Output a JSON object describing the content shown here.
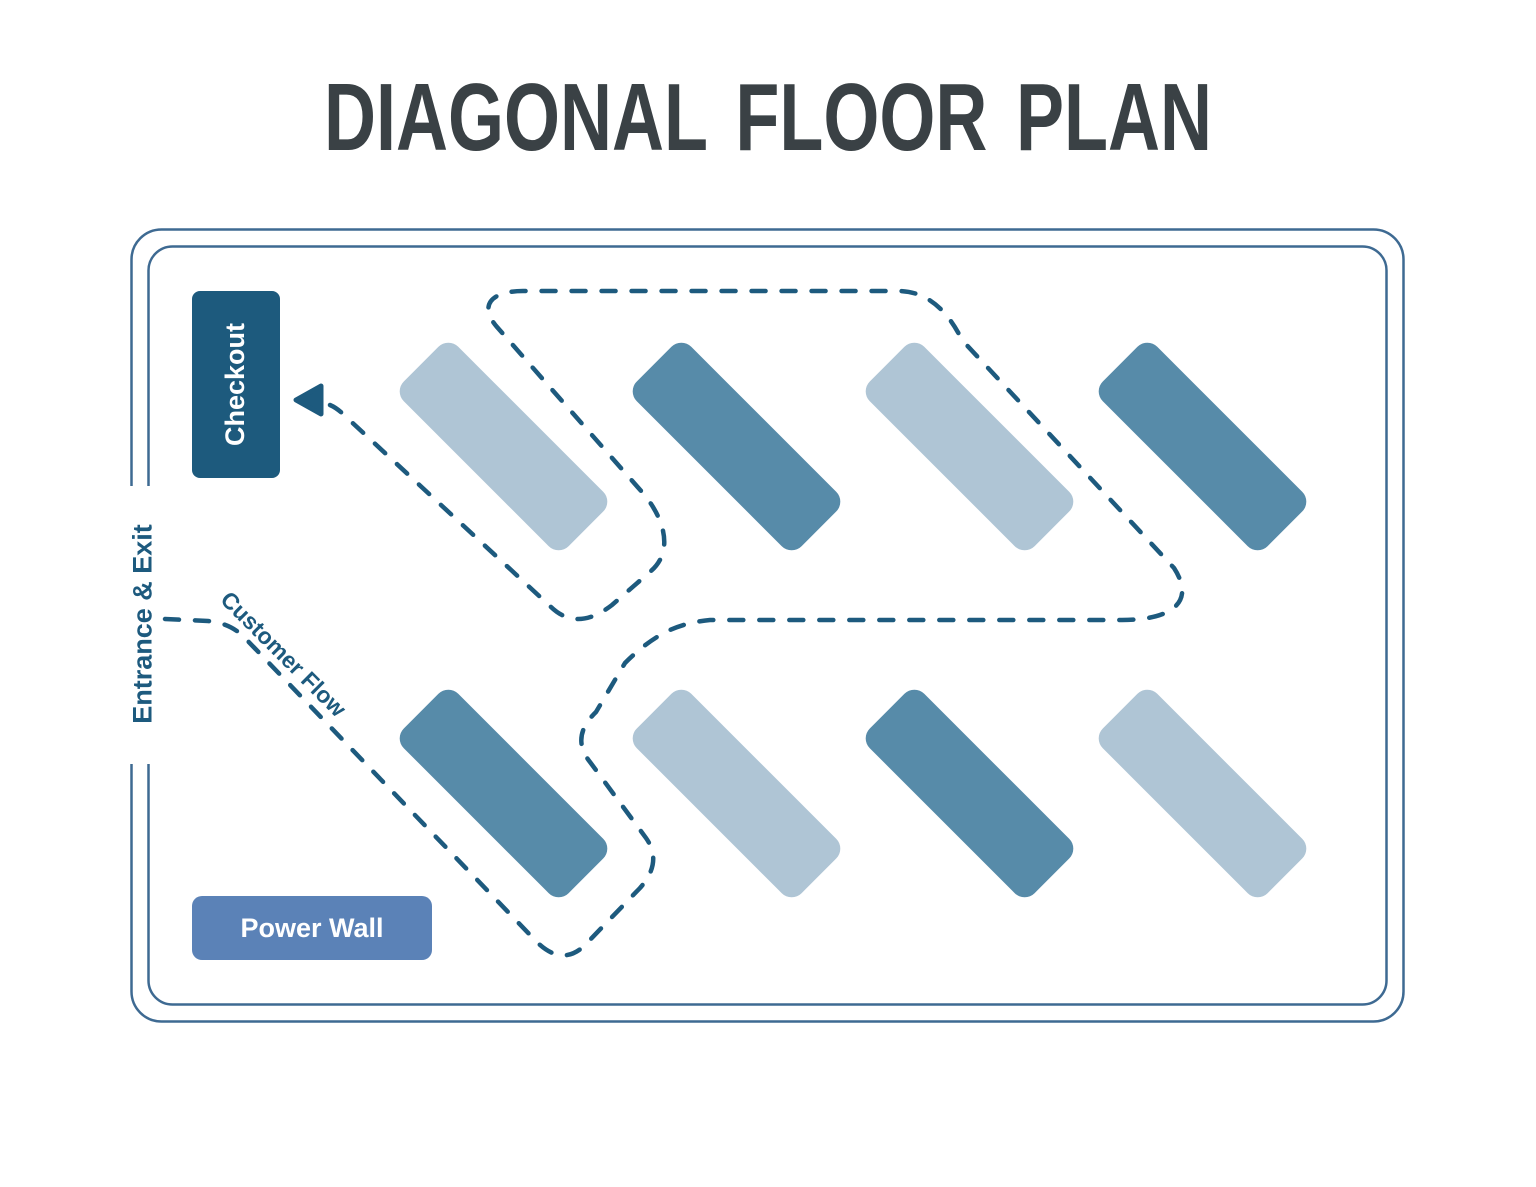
{
  "title": "DIAGONAL FLOOR PLAN",
  "labels": {
    "checkout": "Checkout",
    "entrance_exit": "Entrance & Exit",
    "customer_flow": "Customer Flow",
    "power_wall": "Power Wall"
  },
  "colors": {
    "accent": "#1D5A7E",
    "outline": "#3E6A92",
    "shelf_light": "#AFC5D5",
    "shelf_dark": "#578BA9",
    "checkout_fill": "#1D5A7D",
    "power_wall_fill": "#5B82B7",
    "title_color": "#3A4145",
    "background": "#FFFFFF"
  },
  "diagram": {
    "type": "store-floor-plan",
    "pattern": "diagonal",
    "shelf_rows": [
      {
        "row": "top",
        "tones": [
          "light",
          "dark",
          "light",
          "dark"
        ]
      },
      {
        "row": "bottom",
        "tones": [
          "dark",
          "light",
          "dark",
          "light"
        ]
      }
    ],
    "flow": {
      "label": "Customer Flow",
      "from": "Entrance & Exit",
      "to": "Checkout",
      "style": "dashed"
    }
  }
}
